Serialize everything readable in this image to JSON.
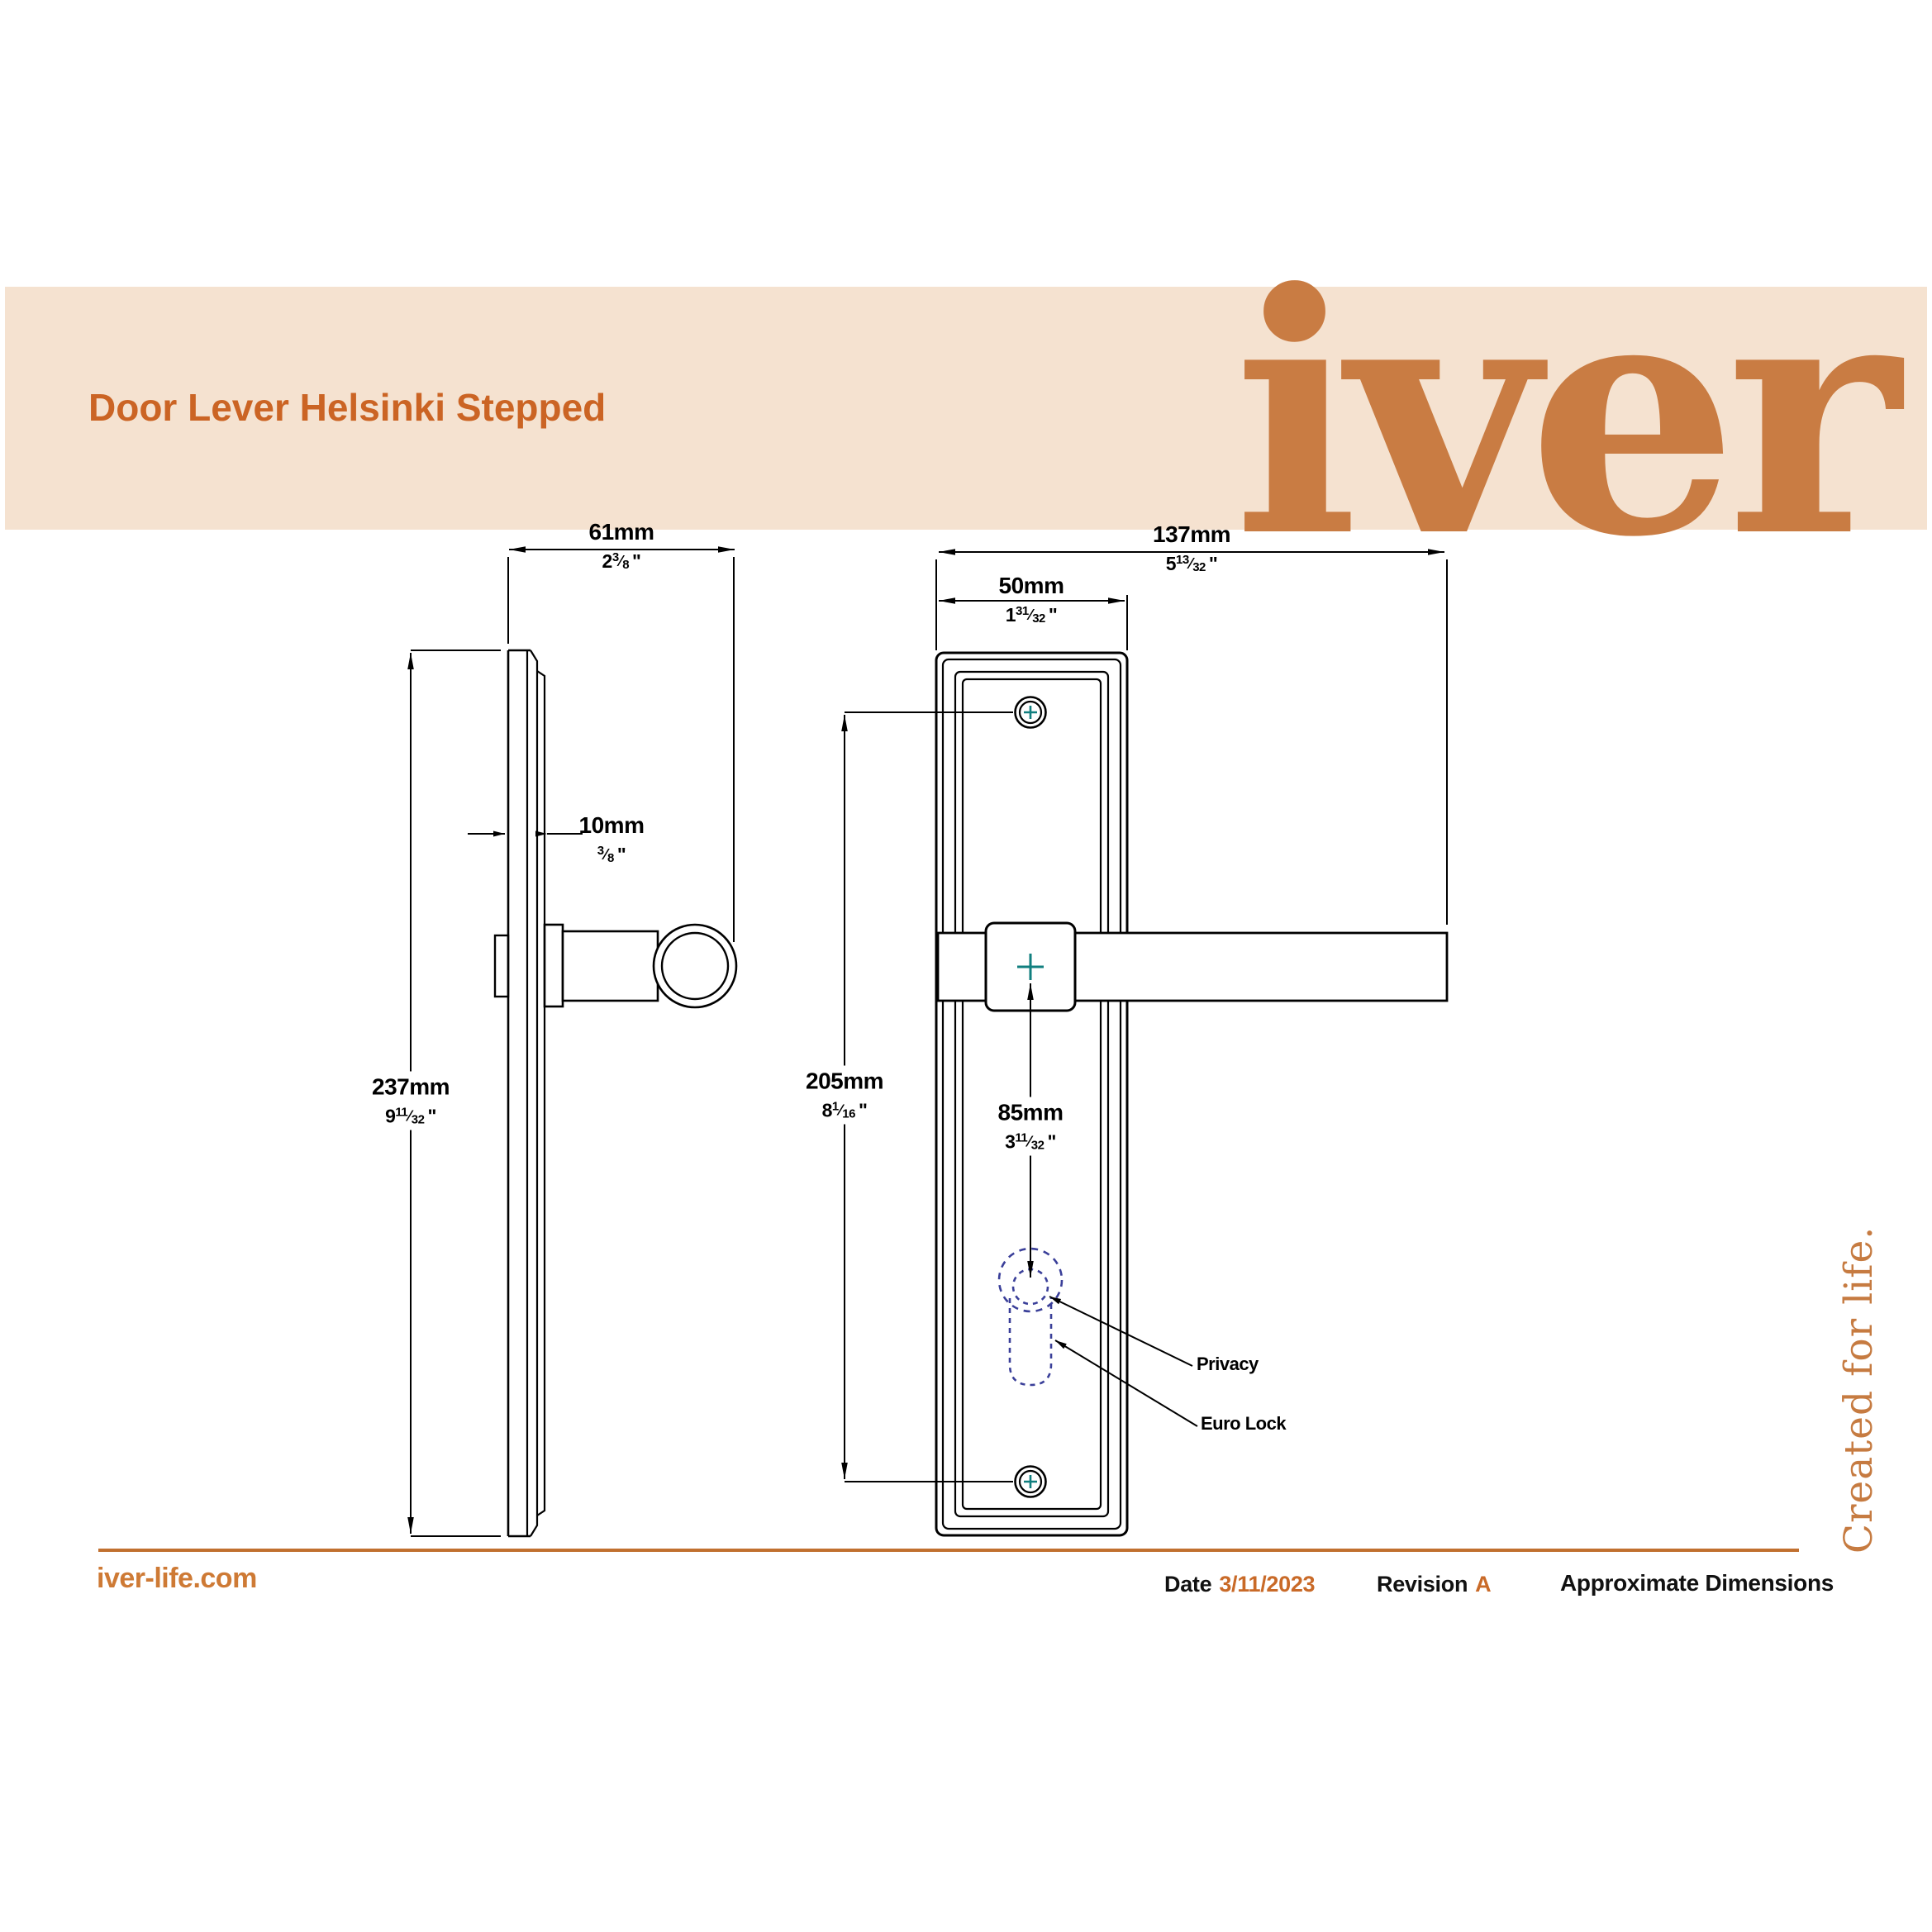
{
  "header": {
    "title": "Door Lever Helsinki Stepped",
    "logo": "iver"
  },
  "dims": {
    "d61": {
      "mm": "61mm",
      "whole": "2",
      "num": "3",
      "den": "8",
      "unit": "\""
    },
    "d10": {
      "mm": "10mm",
      "whole": "",
      "num": "3",
      "den": "8",
      "unit": "\""
    },
    "d237": {
      "mm": "237mm",
      "whole": "9",
      "num": "11",
      "den": "32",
      "unit": "\""
    },
    "d137": {
      "mm": "137mm",
      "whole": "5",
      "num": "13",
      "den": "32",
      "unit": "\""
    },
    "d50": {
      "mm": "50mm",
      "whole": "1",
      "num": "31",
      "den": "32",
      "unit": "\""
    },
    "d205": {
      "mm": "205mm",
      "whole": "8",
      "num": "1",
      "den": "16",
      "unit": "\""
    },
    "d85": {
      "mm": "85mm",
      "whole": "3",
      "num": "11",
      "den": "32",
      "unit": "\""
    }
  },
  "callouts": {
    "privacy": "Privacy",
    "euro": "Euro Lock"
  },
  "footer": {
    "website": "iver-life.com",
    "date_label": "Date",
    "date_value": "3/11/2023",
    "revision_label": "Revision",
    "revision_value": "A",
    "note": "Approximate Dimensions",
    "tagline": "Created for life."
  },
  "colors": {
    "banner_bg": "#F5E2D0",
    "title_orange": "#CB6424",
    "logo_orange": "#C97C43",
    "footer_orange": "#CE7A35",
    "accent_orange": "#C96A28",
    "divider_orange": "#C1702F",
    "tagline_orange": "#C67B41",
    "teal_cross": "#117F7F",
    "keyhole_navy": "#3A3F99",
    "line_black": "#000000"
  }
}
